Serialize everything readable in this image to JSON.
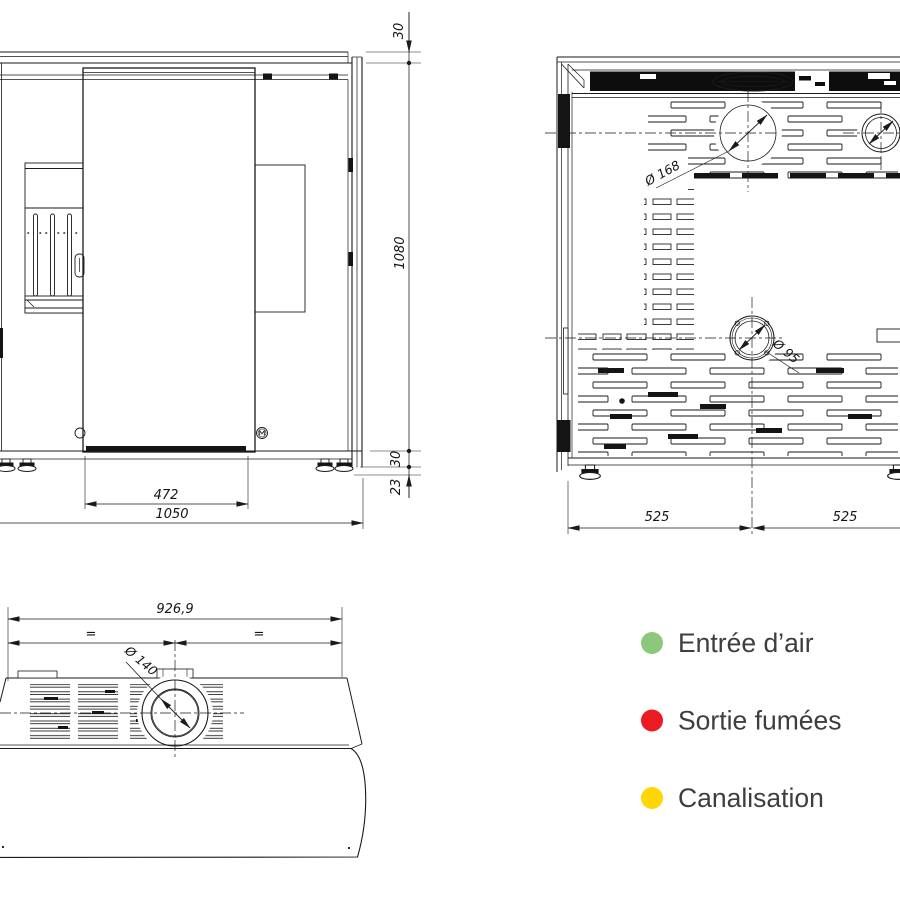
{
  "front_view": {
    "dim_top_cap": "30",
    "dim_height": "1080",
    "dim_base": "30",
    "dim_feet": "23",
    "dim_door_width": "472",
    "dim_total_width": "1050"
  },
  "rear_view": {
    "dim_smoke_diameter": "Ø 168",
    "dim_air_diameter": "Ø 95",
    "dim_left": "525",
    "dim_right": "525",
    "smoke_color": "#ec1b23",
    "duct_color": "#ffe103",
    "air_color": "#5dd41f"
  },
  "top_view": {
    "dim_width": "926,9",
    "dim_equal_left": "=",
    "dim_equal_right": "=",
    "dim_smoke_diameter": "Ø 140",
    "smoke_color": "#ec1b23"
  },
  "legend": {
    "items": [
      {
        "label": "Entrée d’air",
        "color": "#8cc87c"
      },
      {
        "label": "Sortie fumées",
        "color": "#ec1b23"
      },
      {
        "label": "Canalisation",
        "color": "#ffd504"
      }
    ]
  }
}
